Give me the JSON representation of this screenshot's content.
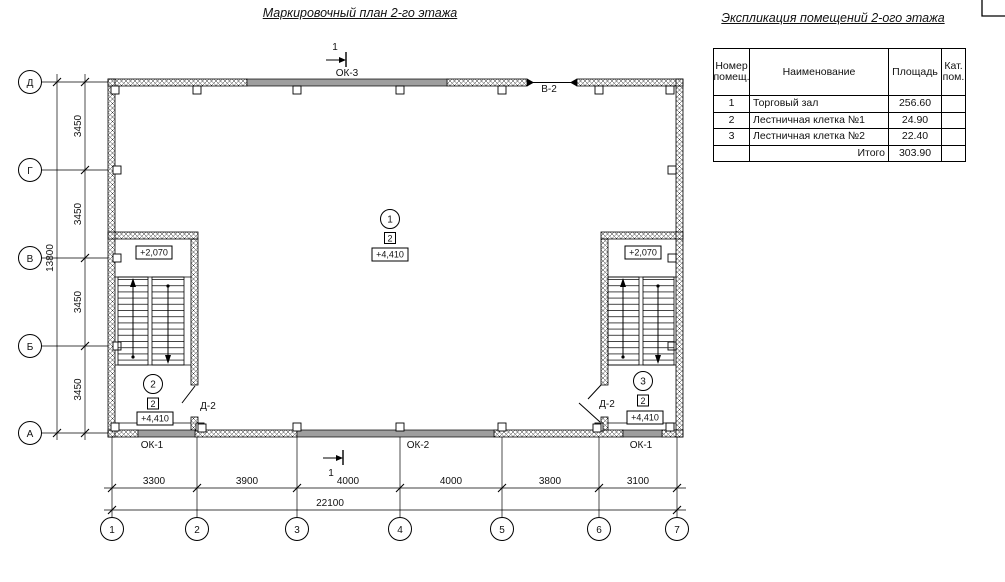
{
  "titles": {
    "plan": "Маркировочный план 2-го этажа",
    "table": "Экспликация помещений 2-ого этажа"
  },
  "table": {
    "col_num": "Номер помещ.",
    "col_name": "Наименование",
    "col_area": "Площадь",
    "col_cat": "Кат. пом.",
    "rows": [
      {
        "num": "1",
        "name": "Торговый зал",
        "area": "256.60",
        "cat": ""
      },
      {
        "num": "2",
        "name": "Лестничная клетка №1",
        "area": "24.90",
        "cat": ""
      },
      {
        "num": "3",
        "name": "Лестничная клетка №2",
        "area": "22.40",
        "cat": ""
      }
    ],
    "total_label": "Итого",
    "total_area": "303.90"
  },
  "axes": {
    "horizontal": [
      "1",
      "2",
      "3",
      "4",
      "5",
      "6",
      "7"
    ],
    "vertical": [
      "Д",
      "Г",
      "В",
      "Б",
      "А"
    ]
  },
  "dims": {
    "bottom": [
      "3300",
      "3900",
      "4000",
      "4000",
      "3800",
      "3100"
    ],
    "bottom_total": "22100",
    "left": [
      "3450",
      "3450",
      "3450",
      "3450"
    ],
    "left_total": "13800"
  },
  "openings": {
    "ok1": "ОК-1",
    "ok2": "ОК-2",
    "ok3": "ОК-3",
    "v2": "В-2",
    "d2": "Д-2"
  },
  "marks": {
    "section": "1",
    "hall": {
      "room": "1",
      "type": "2",
      "elev": "+4,410"
    },
    "stair1": {
      "room": "2",
      "type": "2",
      "elev": "+4,410",
      "landing_elev": "+2,070"
    },
    "stair2": {
      "room": "3",
      "type": "2",
      "elev": "+4,410",
      "landing_elev": "+2,070"
    }
  },
  "colors": {
    "line": "#000000",
    "window_fill": "#9e9e9e"
  }
}
